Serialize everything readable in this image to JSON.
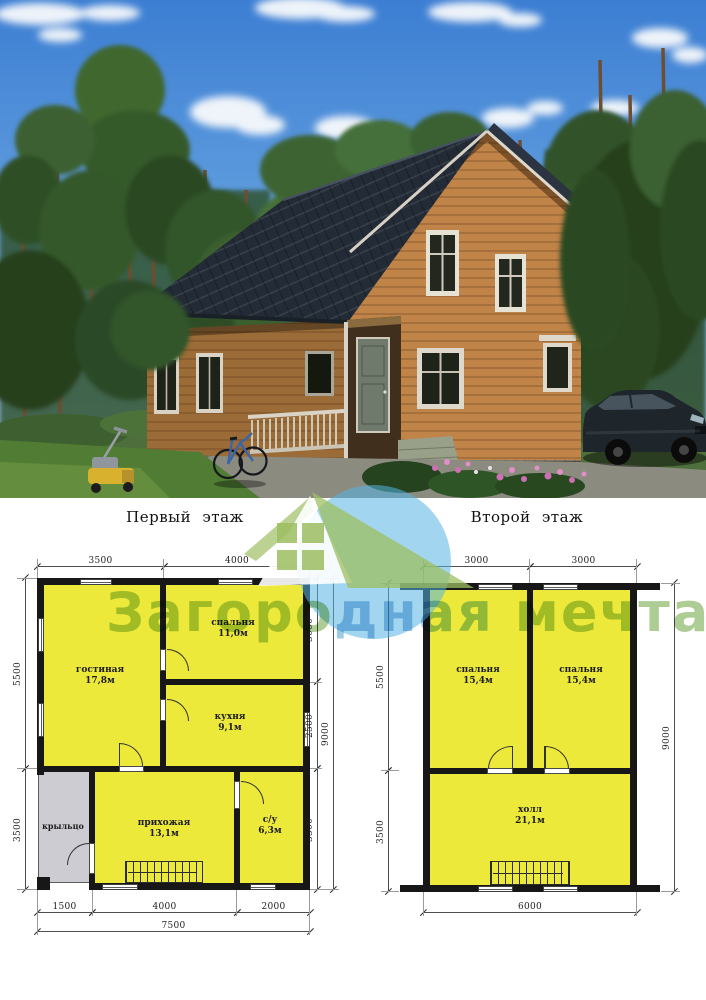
{
  "photo": {
    "content": "exterior-render-of-wooden-two-storey-house"
  },
  "watermark": {
    "segments": [
      {
        "text": "Загоро"
      },
      {
        "text": "дная"
      },
      {
        "text": " мечта"
      }
    ],
    "green": "#69a33b",
    "blue": "#4c9ed4",
    "logo": "house-in-blue-circle"
  },
  "floor1": {
    "title": "Первый этаж",
    "dims": {
      "top": [
        "3500",
        "4000"
      ],
      "left": [
        "5500",
        "3500"
      ],
      "right": [
        "3000",
        "2500",
        "3500"
      ],
      "right_total": "9000",
      "bottom": [
        "1500",
        "4000",
        "2000"
      ],
      "bottom_total": "7500"
    },
    "rooms": [
      {
        "label": "гостиная",
        "area": "17,8м"
      },
      {
        "label": "спальня",
        "area": "11,0м"
      },
      {
        "label": "кухня",
        "area": "9,1м"
      },
      {
        "label": "крыльцо",
        "area": ""
      },
      {
        "label": "прихожая",
        "area": "13,1м"
      },
      {
        "label": "с/у",
        "area": "6,3м"
      }
    ]
  },
  "floor2": {
    "title": "Второй этаж",
    "dims": {
      "top": [
        "3000",
        "3000"
      ],
      "left": [
        "5500",
        "3500"
      ],
      "right_total": "9000",
      "bottom_total": "6000"
    },
    "rooms": [
      {
        "label": "спальня",
        "area": "15,4м"
      },
      {
        "label": "спальня",
        "area": "15,4м"
      },
      {
        "label": "холл",
        "area": "21,1м"
      }
    ]
  },
  "colors": {
    "room_fill": "#ece93b",
    "porch_fill": "#cdccd2",
    "wall": "#171717",
    "roof": "#232b36",
    "siding": "#c08348",
    "sky": "#3c7ed2"
  }
}
